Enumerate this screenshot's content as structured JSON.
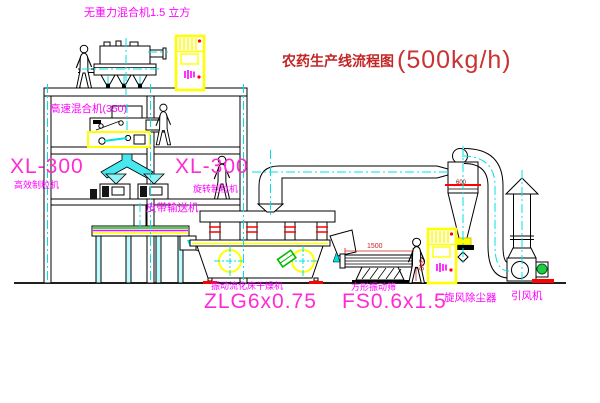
{
  "title": {
    "name": "农药生产线流程图",
    "capacity": "(500kg/h)"
  },
  "labels": {
    "gravity_mixer": "无重力混合机1.5 立方",
    "high_speed_mixer": "高速混合机(350)",
    "granulator_left_model": "XL-300",
    "granulator_left_name": "高效制粒机",
    "granulator_mid_model": "XL-300",
    "granulator_mid_name": "旋转制粒机",
    "belt_conveyor": "皮带输送机",
    "dryer_name": "振动流化床干燥机",
    "dryer_model": "ZLG6x0.75",
    "screen_name": "方形振动筛",
    "screen_model": "FS0.6x1.5",
    "cyclone_name": "旋风除尘器",
    "fan_name": "引风机"
  },
  "dimensions": {
    "screen_length": "1500",
    "screen_height": "340",
    "cyclone_diameter": "600"
  },
  "colors": {
    "label_magenta": "#ff00ff",
    "model_pink": "#ff2ad4",
    "title_red": "#c22626",
    "centerline_cyan": "#00e0e0",
    "cabinet_yellow": "#ffff00",
    "accent_red": "#ff0000",
    "accent_green": "#00bb00",
    "line_black": "#000000"
  }
}
